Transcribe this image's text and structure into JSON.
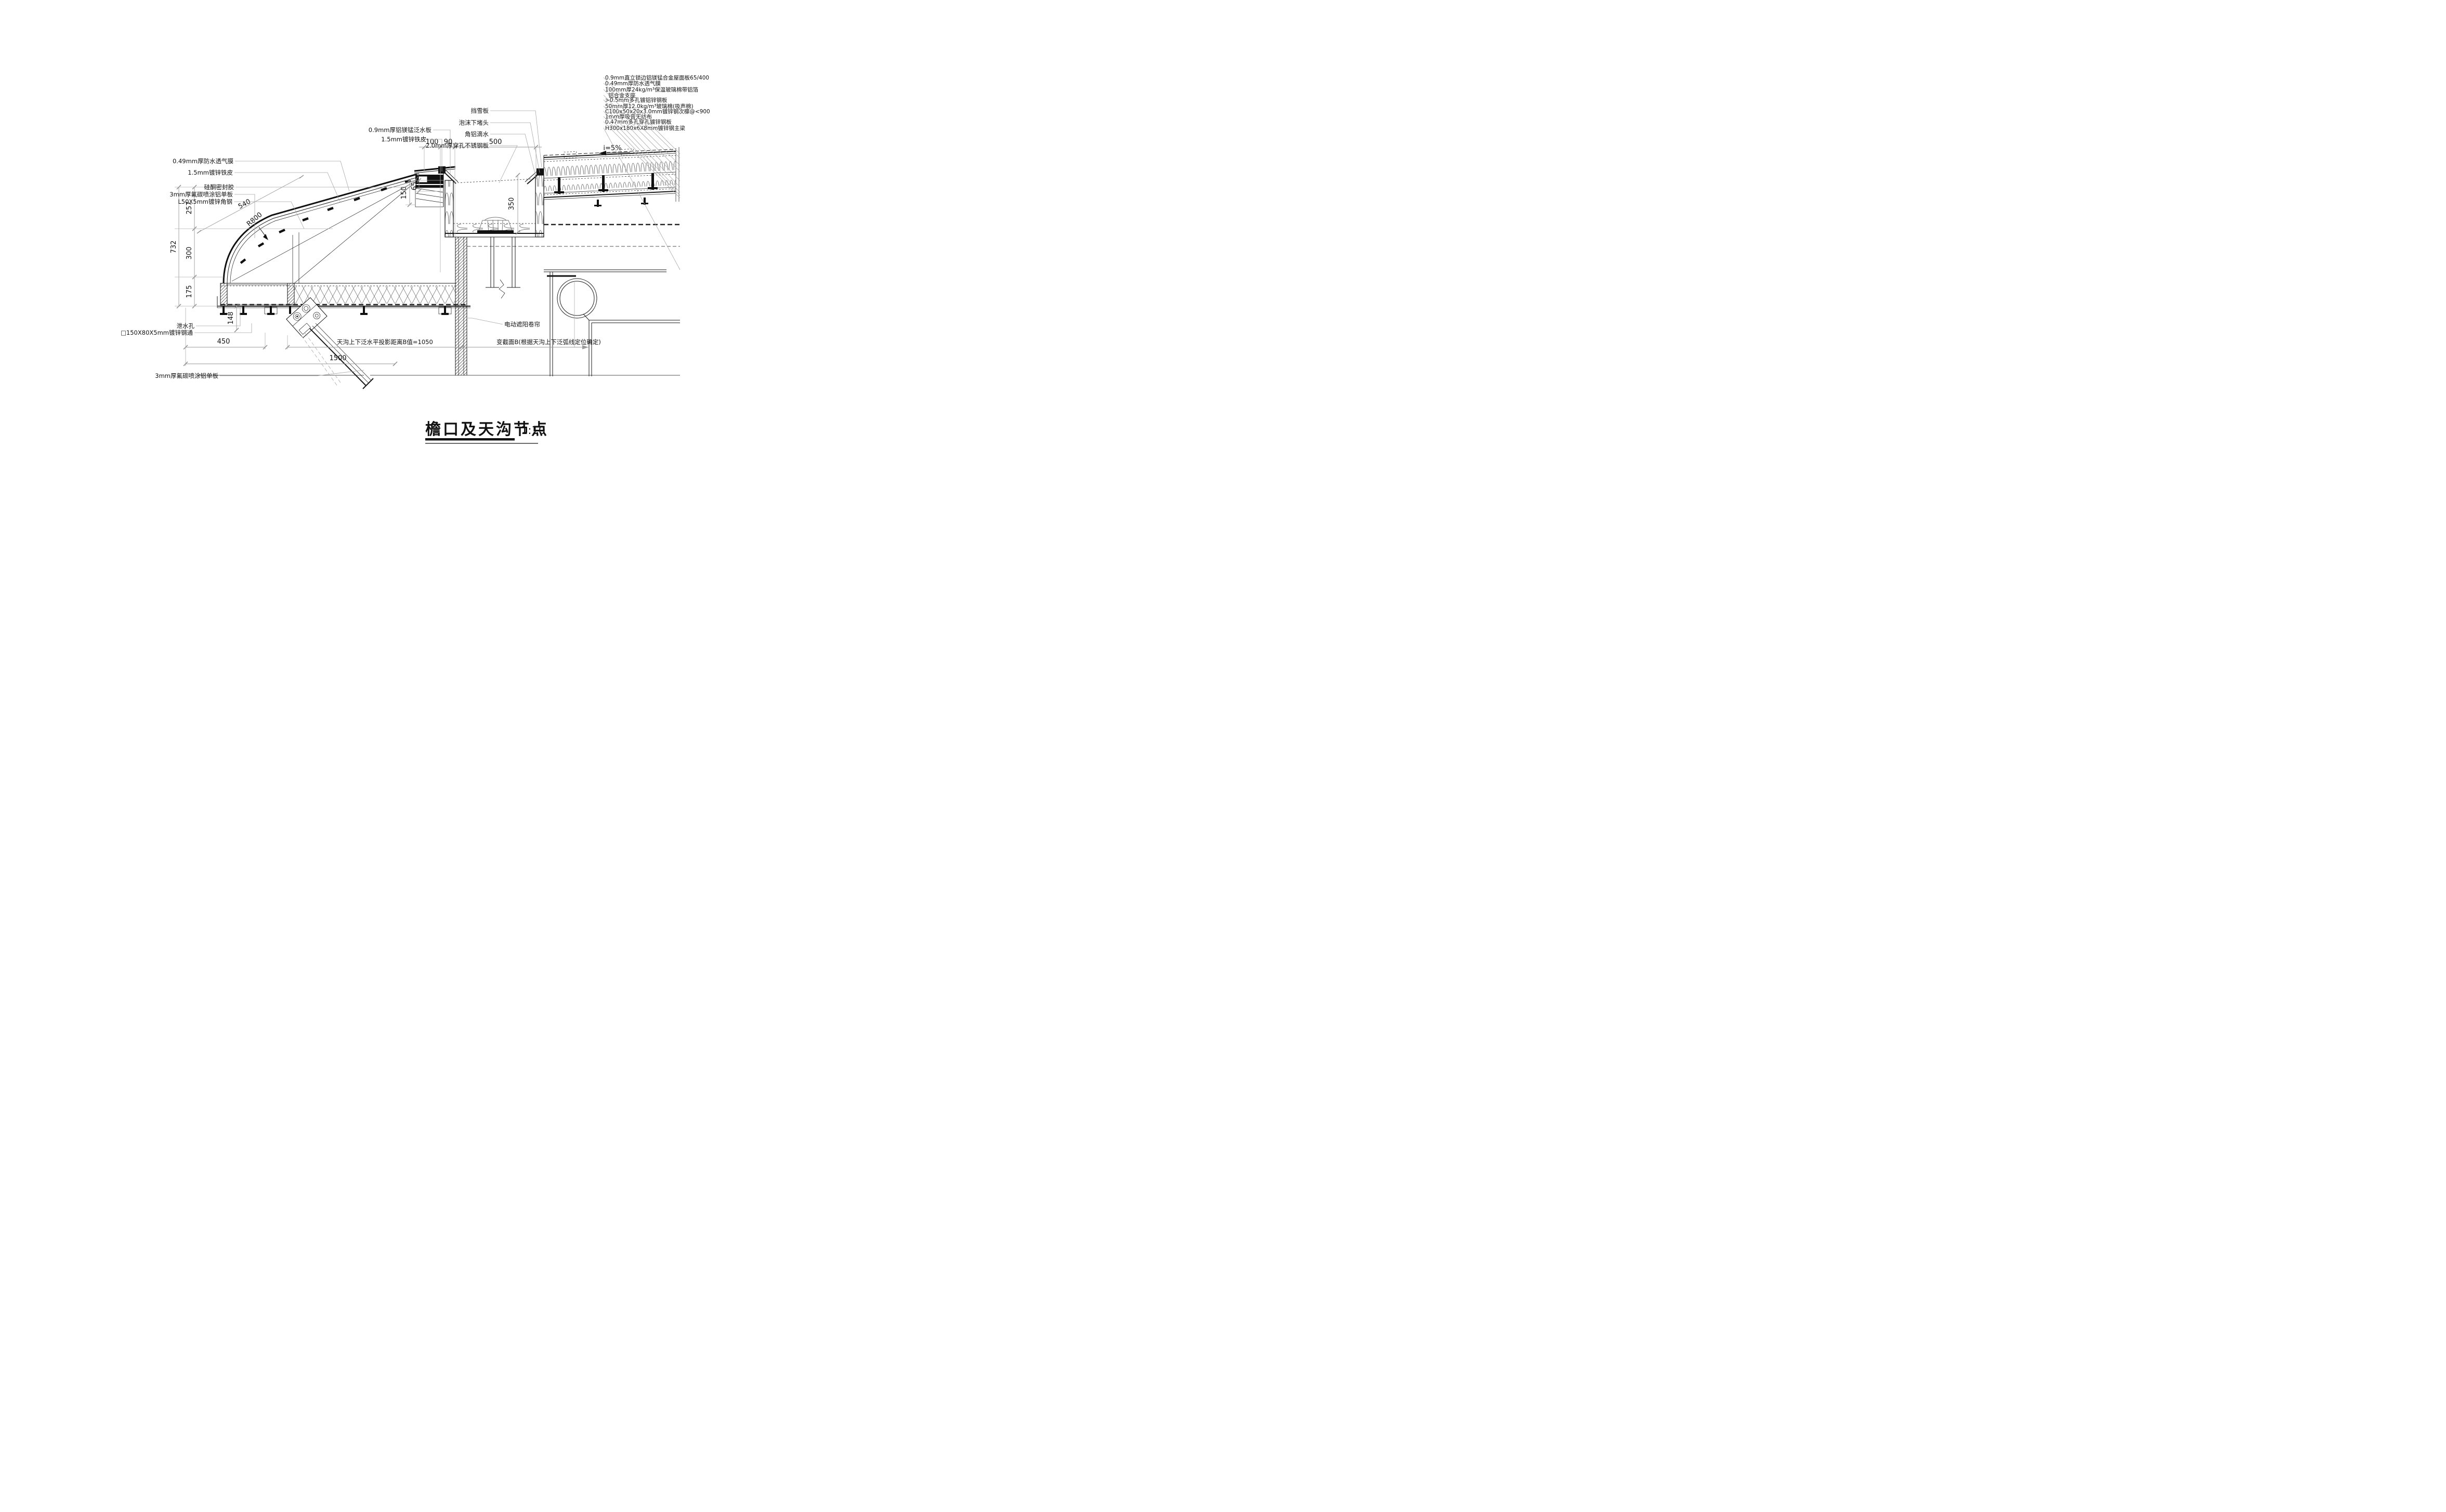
{
  "title": {
    "text": "檐口及天沟节点",
    "scale": "1:10"
  },
  "dims": {
    "d732": "732",
    "d257": "257",
    "d300": "300",
    "d175": "175",
    "d540": "540",
    "r800": "R800",
    "d100": "100",
    "d90": "90",
    "d500": "500",
    "d150": "150",
    "d65": "65",
    "d350": "350",
    "d148": "148",
    "d450": "450",
    "d1500": "1500",
    "slope": "i=5%"
  },
  "callouts_left": {
    "membrane": "0.49mm厚防水透气膜",
    "sheet": "1.5mm镀锌铁皮",
    "sealant": "硅酮密封胶",
    "panel": "3mm厚氟碳喷涂铝单板",
    "angle": "L50X5mm镀锌角钢"
  },
  "callouts_top": {
    "flashing": "0.9mm厚铝镁锰泛水板",
    "sheet": "1.5mm镀锌铁皮",
    "snow": "挡雪板",
    "foam": "泡沫下堵头",
    "drip": "角铝滴水",
    "stainless": "2.0mm厚穿孔不锈钢板"
  },
  "materials_right": [
    "0.9mm直立锁边铝镁锰合金屋面板65/400",
    "0.49mm厚防水透气膜",
    "100mm厚24kg/m³保温玻璃棉带铝箔",
    "铝合金支座",
    ">0.5mm多孔镀铝锌钢板",
    "50mm厚12.0kg/m³玻璃棉(吸声棉)",
    "C100x50x20x3.0mm镀锌钢次檩@<900",
    "1mm厚吸音无纺布",
    "0.47mm多孔穿孔镀锌钢板",
    "H300x180x6X8mm镀锌钢主梁"
  ],
  "callouts_bottom": {
    "drainhole": "泄水孔",
    "tube": "□150X80X5mm镀锌钢通",
    "panel": "3mm厚氟碳喷涂铝单板",
    "projection": "天沟上下泛水平投影距离B值=1050",
    "variable": "变截面B(根据天沟上下泛弧线定位确定)",
    "shade": "电动遮阳卷帘"
  }
}
